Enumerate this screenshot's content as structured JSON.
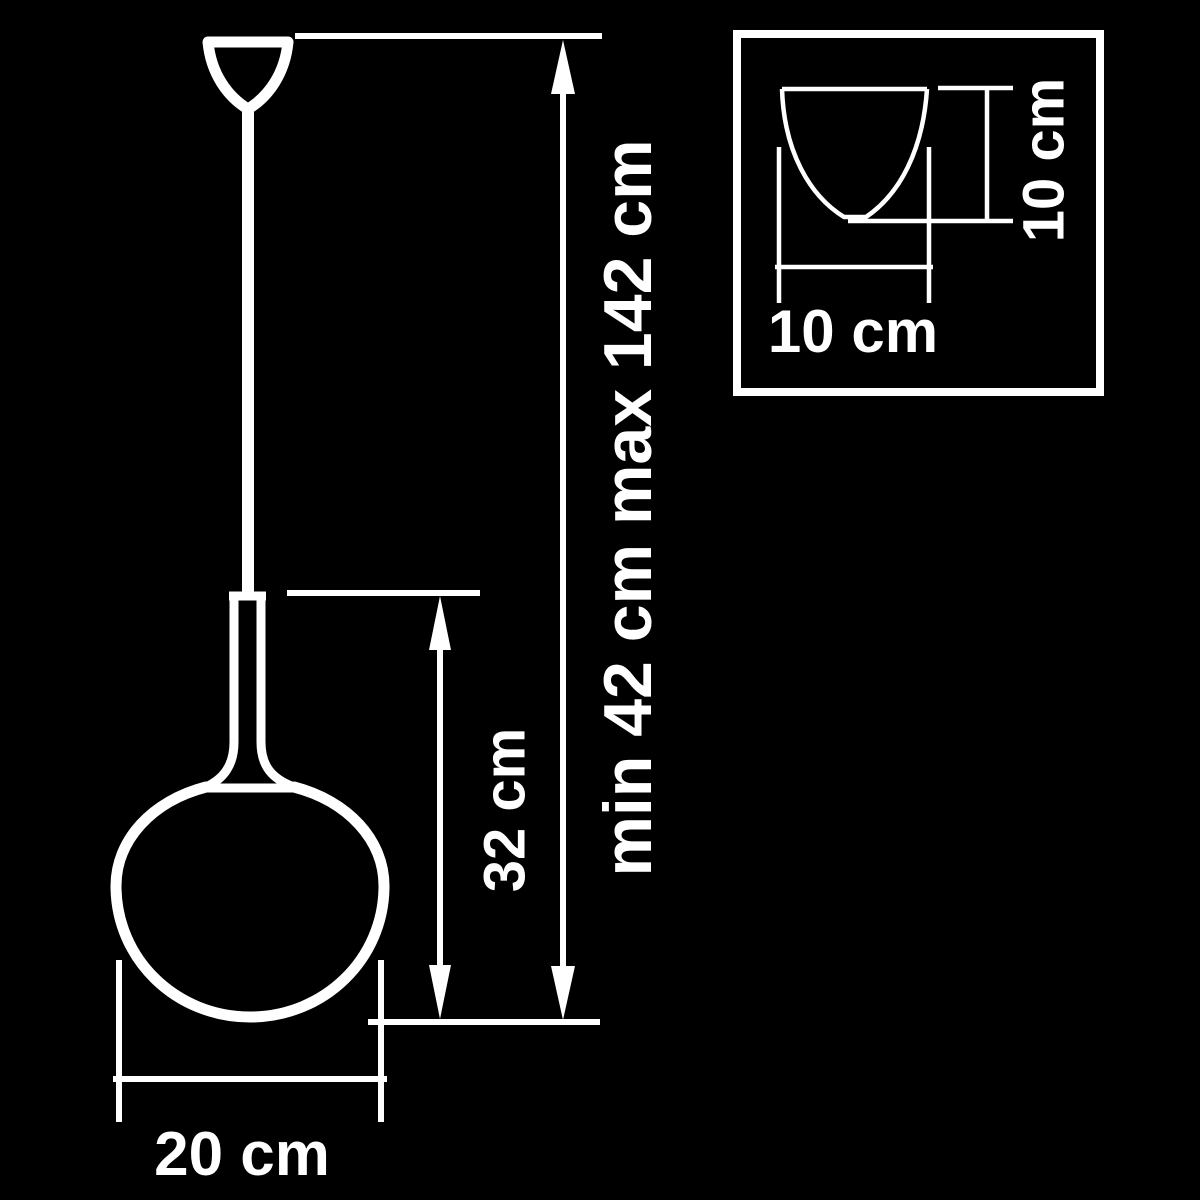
{
  "page": {
    "description": "Technical dimension diagram of a pendant lamp with glass sphere shade and ceiling canopy detail inset",
    "colors": {
      "background": "#000000",
      "line": "#ffffff",
      "text": "#ffffff"
    }
  },
  "main_view": {
    "labels": {
      "total_height": "min 42 cm max 142 cm",
      "fixture_height": "32 cm",
      "shade_diameter": "20 cm"
    }
  },
  "inset_view": {
    "labels": {
      "canopy_width": "10 cm",
      "canopy_height": "10 cm"
    }
  }
}
